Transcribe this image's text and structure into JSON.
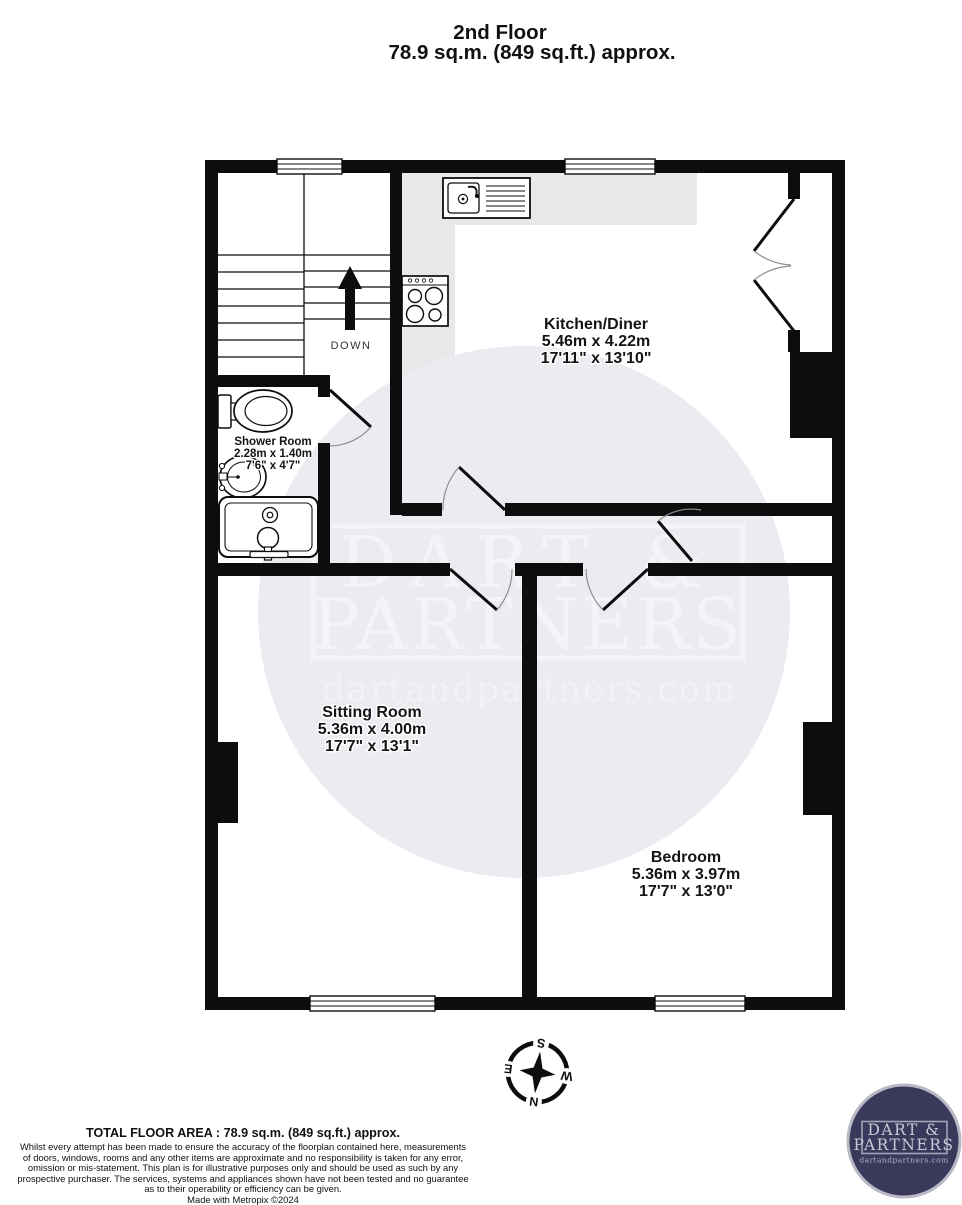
{
  "page": {
    "title_line1": "2nd Floor",
    "title_line2": "78.9 sq.m. (849 sq.ft.) approx."
  },
  "rooms": [
    {
      "name": "Kitchen/Diner",
      "metric": "5.46m  x 4.22m",
      "imperial": "17'11\"  x 13'10\""
    },
    {
      "name": "Shower Room",
      "metric": "2.28m  x 1.40m",
      "imperial": "7'6\"  x 4'7\""
    },
    {
      "name": "Sitting Room",
      "metric": "5.36m  x 4.00m",
      "imperial": "17'7\"  x 13'1\""
    },
    {
      "name": "Bedroom",
      "metric": "5.36m  x 3.97m",
      "imperial": "17'7\"  x 13'0\""
    }
  ],
  "stairs": {
    "direction_label": "DOWN"
  },
  "watermark": {
    "line1": "DART &",
    "line2": "PARTNERS",
    "website": "dartandpartners.com"
  },
  "compass": {
    "n": "N",
    "e": "E",
    "s": "S",
    "w": "W"
  },
  "footer": {
    "total": "TOTAL FLOOR AREA : 78.9 sq.m. (849 sq.ft.) approx.",
    "disclaimer_lines": [
      "Whilst every attempt has been made to ensure the accuracy of the floorplan contained here, measurements",
      "of doors, windows, rooms and any other items are approximate and no responsibility is taken for any error,",
      "omission or mis-statement. This plan is for illustrative purposes only and should be used as such by any",
      "prospective purchaser. The services, systems and appliances shown have not been tested and no guarantee",
      "as to their operability or efficiency can be given."
    ],
    "credit": "Made with Metropix ©2024"
  },
  "logo": {
    "line1": "DART &",
    "line2": "PARTNERS",
    "website": "dartandpartners.com"
  },
  "colors": {
    "wall": "#0d0d0d",
    "counter": "#e8e8e8",
    "watermark_circle": "#ebebf1",
    "watermark_text": "#f4f4f8",
    "logo_background": "#3a395c",
    "logo_text": "#c9c9d5",
    "logo_ring": "#b8b8c4"
  }
}
